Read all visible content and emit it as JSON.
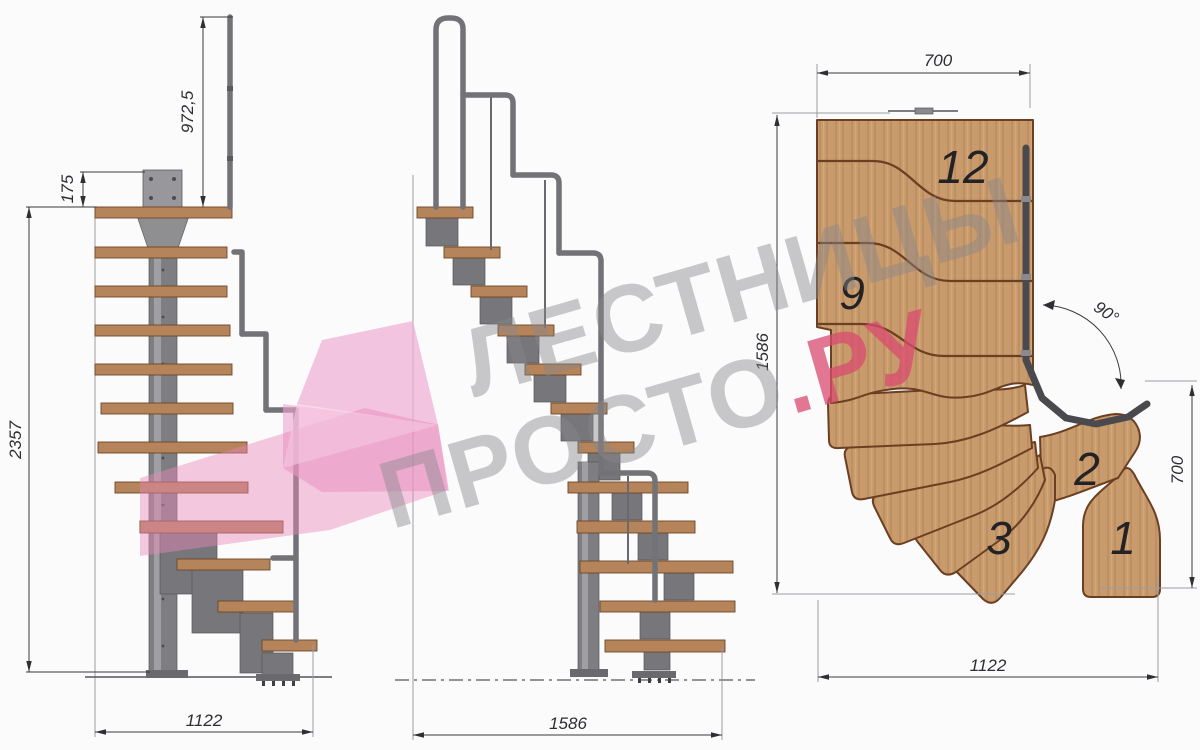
{
  "views": {
    "front_elevation": {
      "dimensions": {
        "handrail_height": "972,5",
        "top_mount_height": "175",
        "total_height": "2357",
        "base_width": "1122"
      }
    },
    "side_elevation": {
      "dimensions": {
        "base_length": "1586"
      }
    },
    "plan_view": {
      "dimensions": {
        "landing_width": "700",
        "plan_depth": "1586",
        "turn_angle": "90°",
        "entry_width": "700",
        "plan_width": "1122"
      },
      "step_labels": [
        {
          "label": "12"
        },
        {
          "label": "9"
        },
        {
          "label": "3"
        },
        {
          "label": "2"
        },
        {
          "label": "1"
        }
      ]
    }
  },
  "watermark": {
    "line1": "ЛЕСТНИЦЫ",
    "line2_gray": "ПРОСТО",
    "line2_accent": ".РУ",
    "gray_color": "#88888c",
    "accent_color": "#d94b70",
    "arrow_color": "#ec9fca"
  },
  "colors": {
    "background": "#fbfbfc",
    "wood_light": "#c89a6c",
    "wood_outline": "#6b3f22",
    "metal": "#7e7e82",
    "dim_line": "#3a3a3e"
  }
}
